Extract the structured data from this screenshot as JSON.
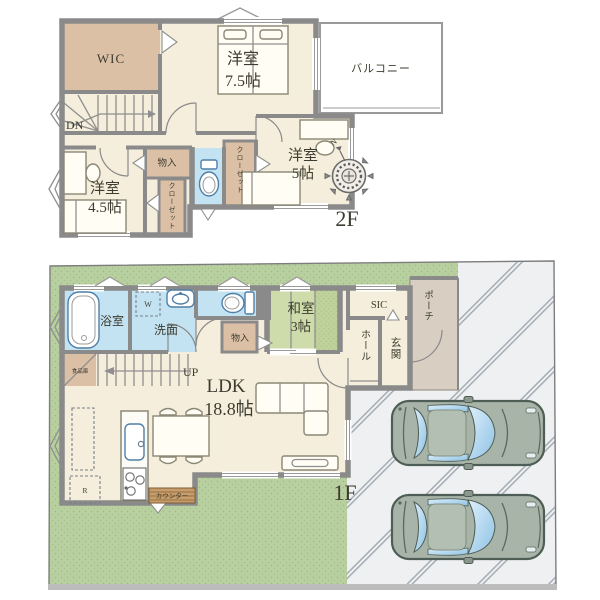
{
  "floor2": {
    "label": "2F",
    "stairs_down": "DN",
    "rooms": {
      "wic": "WIC",
      "bedroom75": {
        "name": "洋室",
        "size": "7.5帖"
      },
      "balcony": "バルコニー",
      "bedroom45": {
        "name": "洋室",
        "size": "4.5帖"
      },
      "bedroom5": {
        "name": "洋室",
        "size": "5帖"
      },
      "storage": "物入",
      "closet_left": "クローゼット",
      "closet_right": "クローゼット"
    }
  },
  "floor1": {
    "label": "1F",
    "stairs_up": "UP",
    "rooms": {
      "bath": "浴室",
      "washroom": "洗面",
      "washer": "W",
      "japanese_room": {
        "name": "和室",
        "size": "3帖"
      },
      "sic": "SIC",
      "porch": "ポーチ",
      "entrance": "玄関",
      "hall": "ホール",
      "storage": "物入",
      "ldk": {
        "name": "LDK",
        "size": "18.8帖"
      },
      "pantry": "食品庫"
    },
    "kitchen": {
      "counter": "カウンター",
      "fridge": "R"
    }
  },
  "compass": {
    "north": "N"
  },
  "site": {
    "cars": 2
  },
  "colors": {
    "wall": "#8a8a8a",
    "room_floor": "#f5eedc",
    "closet_tan": "#dcc0a6",
    "wet_blue": "#c3e3f2",
    "tatami": "#cedcab",
    "tatami_strip": "#c0d29c",
    "lawn": "#b8cf9f",
    "porch": "#d8cec2",
    "driveway": "#eef0f2",
    "car_body": "#a8b4a8",
    "car_glass": "#9cc8e8",
    "counter_wood": "#c79e6b",
    "text": "#3d3c30"
  }
}
